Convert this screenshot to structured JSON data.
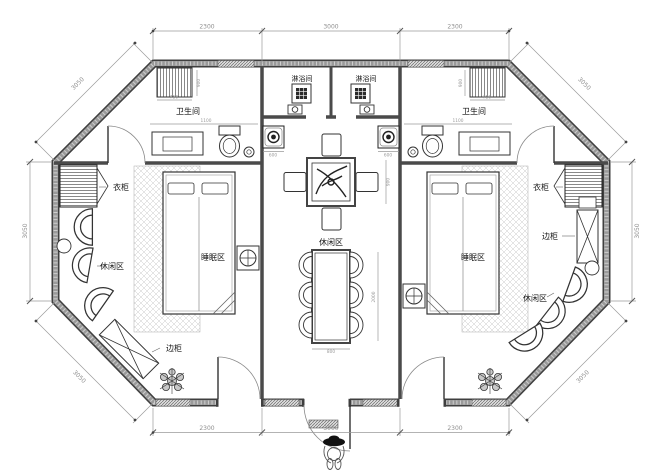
{
  "drawing": {
    "type": "floor-plan",
    "shape": "octagonal cabin with two bedroom suites and central lounge hall"
  },
  "colors": {
    "background": "#ffffff",
    "wall_edge": "#3f3f3f",
    "wall_core": "#9a9a9a",
    "line": "#333333",
    "dim_line": "#9a9a9a",
    "label": "#151515"
  },
  "rooms": {
    "left_bathroom": {
      "label": "卫生间"
    },
    "right_bathroom": {
      "label": "卫生间"
    },
    "left_shower": {
      "label": "淋浴间"
    },
    "right_shower": {
      "label": "淋浴间"
    },
    "hall": {
      "lounge_label": "休闲区"
    },
    "left_bedroom": {
      "sleep_label": "睡眠区",
      "wardrobe_label": "衣柜",
      "lounge_label": "休闲区",
      "cabinet_label": "边柜"
    },
    "right_bedroom": {
      "sleep_label": "睡眠区",
      "wardrobe_label": "衣柜",
      "lounge_label": "休闲区",
      "cabinet_label": "边柜"
    }
  },
  "dimensions": {
    "top": [
      "2300",
      "3000",
      "2300"
    ],
    "bottom": [
      "2300",
      "3000",
      "2300"
    ],
    "left_side": "3050",
    "right_side": "3050",
    "diagonals": {
      "top_left": "3050",
      "top_right": "3050",
      "bottom_left": "3050",
      "bottom_right": "3050"
    },
    "small": {
      "bath": "1100",
      "rack_w": "750",
      "rack_h": "900",
      "basin": "600",
      "tea_side": "900",
      "dining_w": "800",
      "dining_l": "2000"
    }
  }
}
